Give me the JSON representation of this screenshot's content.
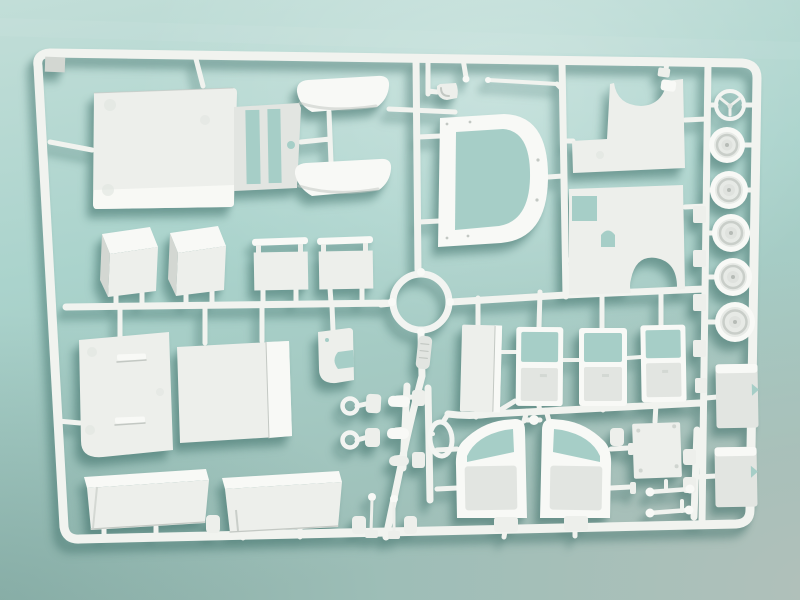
{
  "scene": {
    "title": "Plastic model kit sprue photograph",
    "description": "White injection-moulded polystyrene parts tree for a van model, lying on a plain teal studio background, soft shadow falling down-left"
  },
  "colors": {
    "bg_top": "#c2ded8",
    "bg_mid": "#aad3cc",
    "bg_bottom": "#9dbeb7",
    "bg_corner": "#b4c1bb",
    "bg_through": "#a6cec7",
    "plastic_bright": "#f8f9f6",
    "plastic_main": "#edefeb",
    "plastic_mid": "#e2e5e1",
    "plastic_shade": "#d3d7d2",
    "plastic_deep": "#c3c8c3",
    "plastic_runner": "#f1f3ef",
    "shadow": "rgba(56,104,98,0.42)"
  },
  "parts": {
    "sprue_frame": {
      "label": "Sprue frame (outer runner border)"
    },
    "floor_pan": {
      "label": "Floor pan with firewall slots"
    },
    "seat_shells": {
      "label": "Curved seat shell",
      "count": 2
    },
    "seat_boxes": {
      "label": "Seat base box",
      "count": 2
    },
    "seat_backs": {
      "label": "Seat back panel with header bar",
      "count": 2
    },
    "windshield_frame": {
      "label": "Windscreen frame with rounded opening"
    },
    "body_side_upper": {
      "label": "Body side panel with wheel-arch scoop (front)"
    },
    "body_side_lower": {
      "label": "Body side panel with wheel arch (rear)"
    },
    "steering_wheel": {
      "label": "Steering wheel with V-spokes"
    },
    "road_wheels": {
      "label": "Road wheel with recessed hub",
      "count": 5
    },
    "wheel_tabs": {
      "label": "Small flat tab on wheel rail",
      "count": 5
    },
    "large_ring": {
      "label": "Large open ring"
    },
    "part_tag": {
      "label": "Moulded part-number tag (text illegible)"
    },
    "bulkhead_panel": {
      "label": "Bulkhead panel with two grab handles"
    },
    "folded_panel": {
      "label": "Folded floor panel"
    },
    "bracket": {
      "label": "Mounting bracket with cut-out"
    },
    "van_doors": {
      "label": "Van door with window opening",
      "count": 3
    },
    "side_panel": {
      "label": "Narrow side panel"
    },
    "access_panel": {
      "label": "Square access panel"
    },
    "door_frames": {
      "label": "Cab door frame, mirrored pair",
      "count": 2
    },
    "cargo_trays": {
      "label": "Folded cargo tray",
      "count": 2
    },
    "rear_blocks": {
      "label": "Notched rear panel block",
      "count": 2
    },
    "links": {
      "label": "Rod link with ball ends",
      "count": 2
    },
    "grommets": {
      "label": "Small ring grommet",
      "count": 2
    },
    "levers": {
      "label": "Lever with ball top and base pad",
      "count": 2
    },
    "loop": {
      "label": "Oval wire loop"
    },
    "scoop": {
      "label": "Small scoop / funnel"
    },
    "rod": {
      "label": "Thin straight rod"
    },
    "small_fittings": {
      "label": "Assorted small fittings and pads"
    }
  }
}
